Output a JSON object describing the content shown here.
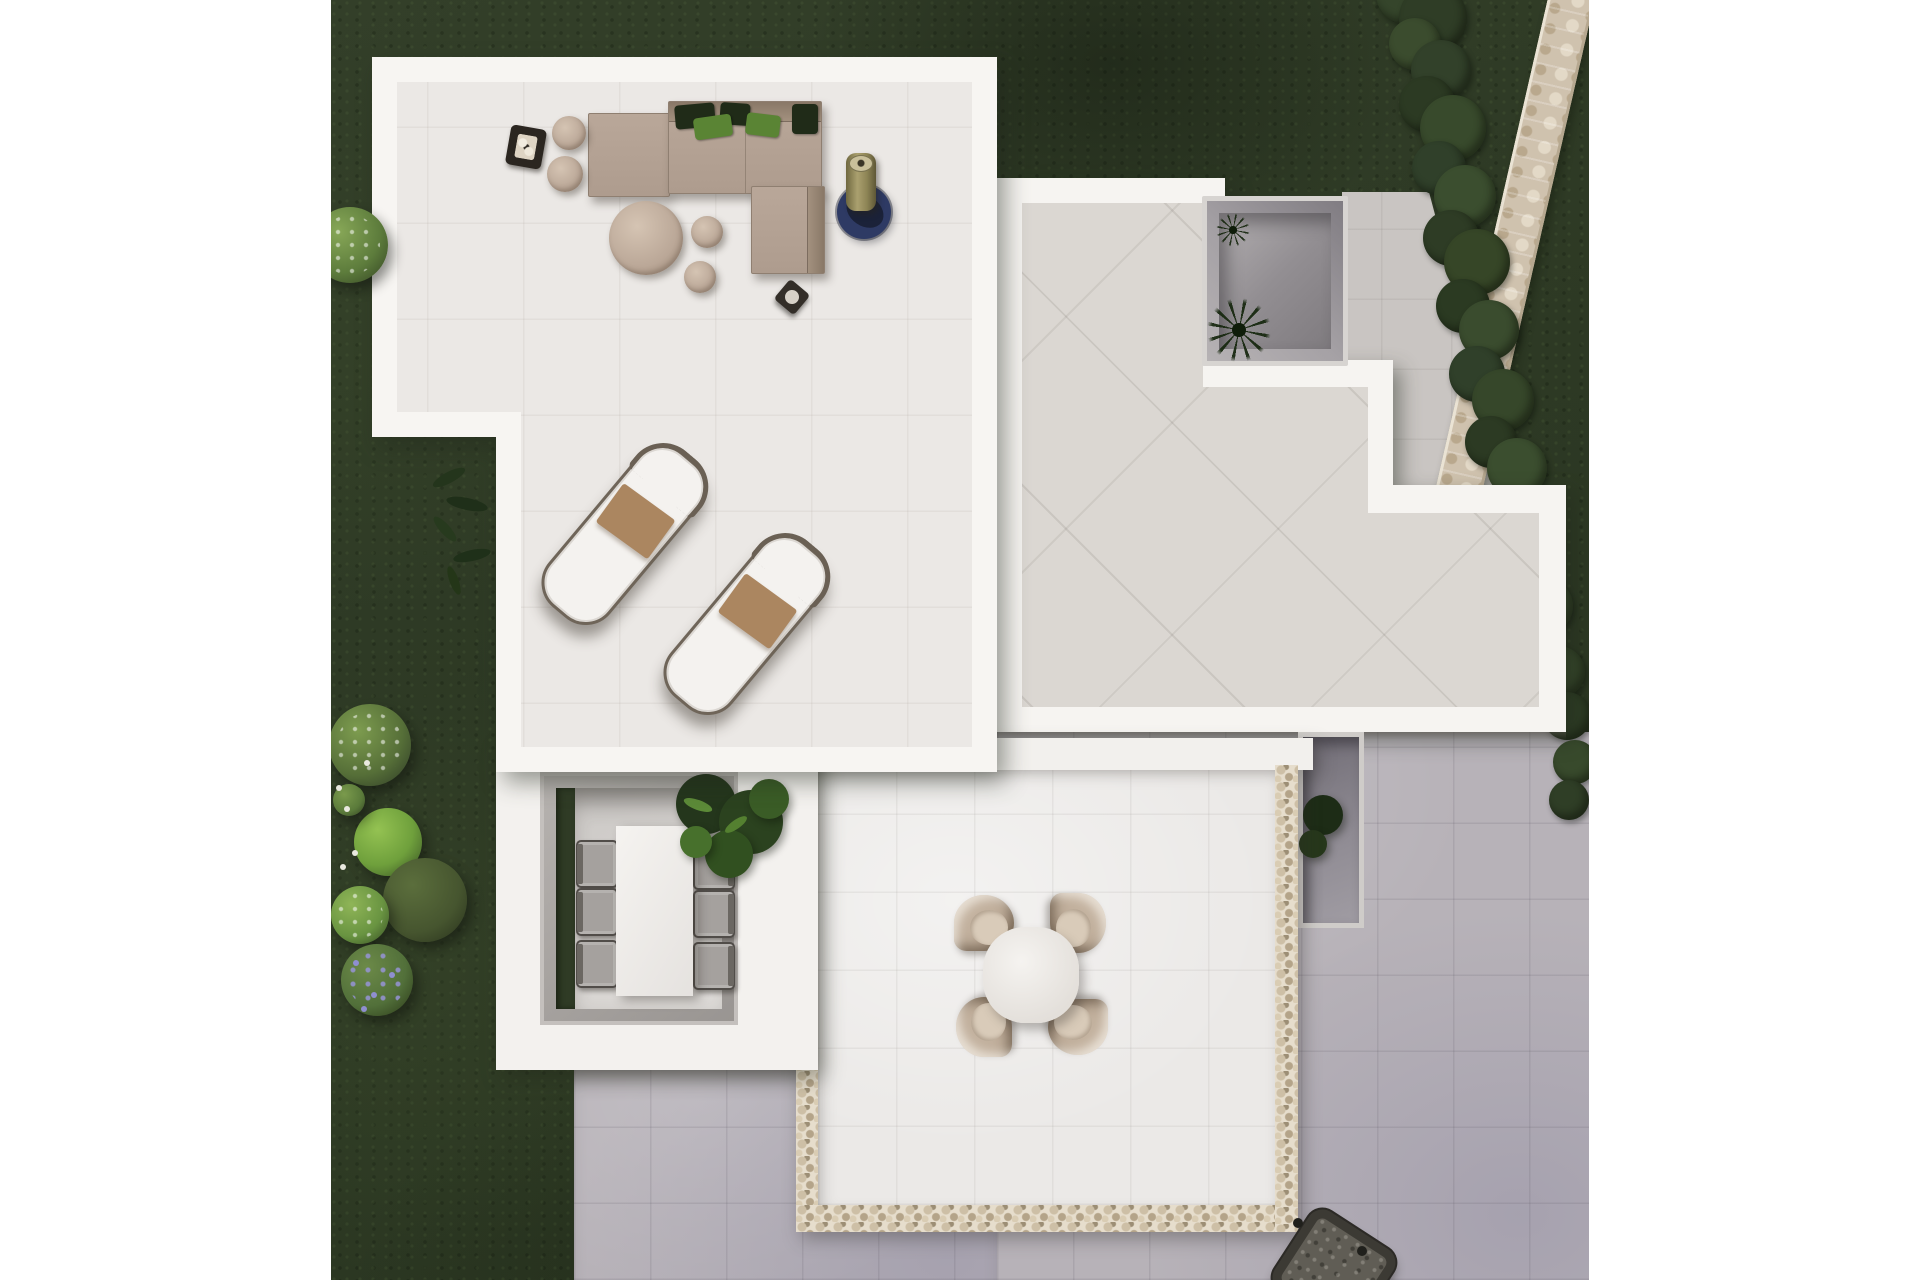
{
  "meta": {
    "title": "Aerial 3D render of a modern villa with roof terraces and garden",
    "canvas": {
      "width": 1920,
      "height": 1280
    },
    "content_area": {
      "left": 331,
      "width": 1258,
      "height": 1280
    }
  },
  "palette": {
    "page": "#ffffff",
    "grass": "#2e3a25",
    "hedge": "#35452b",
    "wallStone": "#cfc2ae",
    "structureWhite": "#f6f4f1",
    "loungeTile": "#ebe8e5",
    "buildingTile": "#dbd7d2",
    "pavingCool": "#b7b2b8",
    "pavingWarm": "#c9c5c2",
    "pebble": "#e6ddcc",
    "courtyardWall": "#a5a1a5",
    "sofaTaupe": "#b3a193",
    "pillowDark": "#202b18",
    "pillowGreen": "#5a8434",
    "woodTaupe": "#bba898",
    "towel": "#ab8660",
    "loungerCushion": "#f4f2ef",
    "loungerFrame": "#6f6559",
    "rugBlue": "#2e3a64",
    "heaterKhaki": "#a49a6b",
    "tableWhite": "#f2f0ed",
    "chairTaupe": "#c0ae9b",
    "chairGray": "#a5a19e",
    "plantDark": "#24361c",
    "plantMid": "#315020",
    "plantLight": "#47702c",
    "flowerPurple": "#8f8fd0",
    "flowerWhite": "#e9e9df",
    "firePit": "#605d55"
  },
  "objects": [
    {
      "name": "lawn",
      "label": "dark green garden lawn"
    },
    {
      "name": "perimeter-stone-wall",
      "label": "diagonal natural stone wall, top right"
    },
    {
      "name": "boxwood-hedge",
      "label": "irregular hedge along the stone wall"
    },
    {
      "name": "lounge-roof-terrace",
      "label": "white-parapet terrace, top left"
    },
    {
      "name": "corner-sofa",
      "label": "taupe L-shaped outdoor sofa with green pillows"
    },
    {
      "name": "coffee-table",
      "label": "round taupe coffee table with two poufs"
    },
    {
      "name": "side-tables",
      "label": "two cylindrical side tables"
    },
    {
      "name": "candle-lantern",
      "label": "dark square lantern tray"
    },
    {
      "name": "outdoor-rug",
      "label": "round navy rug with patio heater"
    },
    {
      "name": "side-stool",
      "label": "small dark stool"
    },
    {
      "name": "sun-loungers",
      "label": "two white sun loungers with brown towels",
      "count": 2
    },
    {
      "name": "central-roof-terrace",
      "label": "stepped white roof with diagonal stone tiles"
    },
    {
      "name": "sunken-courtyard",
      "label": "recessed courtyard with palm"
    },
    {
      "name": "paved-patio",
      "label": "gray tiled ground patios"
    },
    {
      "name": "sunken-dining-patio",
      "label": "recessed dining area with table and six chairs"
    },
    {
      "name": "potted-fig-plant",
      "label": "leafy green plant beside dining patio"
    },
    {
      "name": "pebble-bordered-terrace",
      "label": "lower terrace framed with pebble strip"
    },
    {
      "name": "round-bistro-set",
      "label": "round table with four taupe chairs"
    },
    {
      "name": "sunken-planter",
      "label": "small recessed planter with dark plant"
    },
    {
      "name": "garden-bushes",
      "label": "shrubs and flowering bushes, left edge"
    },
    {
      "name": "lavender-patch",
      "label": "purple flowering patch, lower left"
    },
    {
      "name": "fire-pit-grill",
      "label": "dark square fire pit, bottom right"
    }
  ],
  "shapes": [
    {
      "layer": "hedge",
      "name": "hedge-blob",
      "cls": "hblob",
      "x": 1045,
      "y": -36,
      "r": 30,
      "bg": "#35452b"
    },
    {
      "layer": "hedge",
      "name": "hedge-blob",
      "cls": "hblob",
      "x": 1068,
      "y": -16,
      "r": 34,
      "bg": "#2f3d26"
    },
    {
      "layer": "hedge",
      "name": "hedge-blob",
      "cls": "hblob",
      "x": 1058,
      "y": 18,
      "r": 26,
      "bg": "#3b4c2e"
    },
    {
      "layer": "hedge",
      "name": "hedge-blob",
      "cls": "hblob",
      "x": 1080,
      "y": 40,
      "r": 30,
      "bg": "#32412a"
    },
    {
      "layer": "hedge",
      "name": "hedge-blob",
      "cls": "hblob",
      "x": 1068,
      "y": 76,
      "r": 28,
      "bg": "#2c3a23"
    },
    {
      "layer": "hedge",
      "name": "hedge-blob",
      "cls": "hblob",
      "x": 1089,
      "y": 95,
      "r": 33,
      "bg": "#384a2c"
    },
    {
      "layer": "hedge",
      "name": "hedge-blob",
      "cls": "hblob",
      "x": 1081,
      "y": 141,
      "r": 27,
      "bg": "#30402a"
    },
    {
      "layer": "hedge",
      "name": "hedge-blob",
      "cls": "hblob",
      "x": 1103,
      "y": 165,
      "r": 31,
      "bg": "#3b4e2f"
    },
    {
      "layer": "hedge",
      "name": "hedge-blob",
      "cls": "hblob",
      "x": 1092,
      "y": 210,
      "r": 28,
      "bg": "#2e3c25"
    },
    {
      "layer": "hedge",
      "name": "hedge-blob",
      "cls": "hblob",
      "x": 1113,
      "y": 229,
      "r": 33,
      "bg": "#364627"
    },
    {
      "layer": "hedge",
      "name": "hedge-blob",
      "cls": "hblob",
      "x": 1105,
      "y": 279,
      "r": 27,
      "bg": "#2b3a22"
    },
    {
      "layer": "hedge",
      "name": "hedge-blob",
      "cls": "hblob",
      "x": 1128,
      "y": 300,
      "r": 30,
      "bg": "#3a4c2e"
    },
    {
      "layer": "hedge",
      "name": "hedge-blob",
      "cls": "hblob",
      "x": 1118,
      "y": 346,
      "r": 28,
      "bg": "#30402a"
    },
    {
      "layer": "hedge",
      "name": "hedge-blob",
      "cls": "hblob",
      "x": 1141,
      "y": 369,
      "r": 31,
      "bg": "#36472a"
    },
    {
      "layer": "hedge",
      "name": "hedge-blob",
      "cls": "hblob",
      "x": 1134,
      "y": 416,
      "r": 26,
      "bg": "#2c3a23"
    },
    {
      "layer": "hedge",
      "name": "hedge-blob",
      "cls": "hblob",
      "x": 1156,
      "y": 438,
      "r": 30,
      "bg": "#3b4e2f"
    },
    {
      "layer": "hedge",
      "name": "hedge-blob",
      "cls": "hblob",
      "x": 1149,
      "y": 485,
      "r": 27,
      "bg": "#31422a"
    },
    {
      "layer": "hedge",
      "name": "hedge-blob",
      "cls": "hblob",
      "x": 1170,
      "y": 508,
      "r": 30,
      "bg": "#364728"
    },
    {
      "layer": "hedge",
      "name": "hedge-blob",
      "cls": "hblob",
      "x": 1166,
      "y": 554,
      "r": 26,
      "bg": "#2d3b24"
    },
    {
      "layer": "hedge",
      "name": "hedge-blob",
      "cls": "hblob",
      "x": 1186,
      "y": 578,
      "r": 28,
      "bg": "#3a4c2e"
    },
    {
      "layer": "hedge",
      "name": "hedge-blob",
      "cls": "hblob",
      "x": 1182,
      "y": 624,
      "r": 24,
      "bg": "#30402a"
    },
    {
      "layer": "hedge",
      "name": "hedge-blob",
      "cls": "hblob",
      "x": 1202,
      "y": 646,
      "r": 26,
      "bg": "#35462a"
    },
    {
      "layer": "hedge",
      "name": "hedge-blob",
      "cls": "hblob",
      "x": 1212,
      "y": 692,
      "r": 24,
      "bg": "#2d3c24"
    },
    {
      "layer": "hedge",
      "name": "hedge-blob",
      "cls": "hblob",
      "x": 1222,
      "y": 740,
      "r": 22,
      "bg": "#384a2c"
    },
    {
      "layer": "hedge",
      "name": "hedge-blob",
      "cls": "hblob",
      "x": 1218,
      "y": 780,
      "r": 20,
      "bg": "#2f3e26"
    },
    {
      "layer": "veg",
      "name": "bush",
      "cls": "bush speck",
      "x": -19,
      "y": 207,
      "r": 38,
      "bg": "radial-gradient(circle at 35% 32%, #87a757, #5d7c3c 58%, #3c4f28 90%)"
    },
    {
      "layer": "veg",
      "name": "bush",
      "cls": "bush speck",
      "x": -2,
      "y": 704,
      "r": 41,
      "bg": "radial-gradient(circle at 35% 32%, #7d9c4f, #566f38 58%, #36452a 90%)"
    },
    {
      "layer": "veg",
      "name": "bush",
      "cls": "bush",
      "x": 23,
      "y": 808,
      "r": 34,
      "bg": "radial-gradient(circle at 35% 32%, #94c252, #6fa03c 55%, #44632a 90%)"
    },
    {
      "layer": "veg",
      "name": "bush",
      "cls": "bush",
      "x": 52,
      "y": 858,
      "r": 42,
      "bg": "radial-gradient(circle at 35% 32%, #5b6e3c, #46552f 60%, #2d371f 92%)"
    },
    {
      "layer": "veg",
      "name": "bush",
      "cls": "bush speck",
      "x": 0,
      "y": 886,
      "r": 29,
      "bg": "radial-gradient(circle at 35% 32%, #8fb557, #699441 58%, #415c2a 90%)"
    },
    {
      "layer": "veg",
      "name": "bush",
      "cls": "bush speckp",
      "x": 10,
      "y": 944,
      "r": 36,
      "bg": "radial-gradient(circle at 35% 32%, #6c8a48, #52703a 58%, #33441f 90%)"
    },
    {
      "layer": "veg",
      "name": "bush",
      "cls": "bush",
      "x": 2,
      "y": 784,
      "r": 16,
      "bg": "radial-gradient(circle at 35% 32%, #7a9a4c, #5a7a3a 60%, #3a4c26 92%)"
    },
    {
      "layer": "veg",
      "name": "flower-dot",
      "cls": "dot",
      "x": 5,
      "y": 785,
      "r": 3,
      "bg": "#e9e9df"
    },
    {
      "layer": "veg",
      "name": "flower-dot",
      "cls": "dot",
      "x": 13,
      "y": 806,
      "r": 3,
      "bg": "#e9e9df"
    },
    {
      "layer": "veg",
      "name": "flower-dot",
      "cls": "dot",
      "x": 21,
      "y": 850,
      "r": 3,
      "bg": "#e9e9df"
    },
    {
      "layer": "veg",
      "name": "flower-dot",
      "cls": "dot",
      "x": 9,
      "y": 864,
      "r": 3,
      "bg": "#e9e9df"
    },
    {
      "layer": "veg",
      "name": "flower-dot",
      "cls": "dot",
      "x": 33,
      "y": 760,
      "r": 3,
      "bg": "#e9e9df"
    },
    {
      "layer": "veg",
      "name": "flower-dot",
      "cls": "dot",
      "x": 22,
      "y": 960,
      "r": 3,
      "bg": "#8f8fd0"
    },
    {
      "layer": "veg",
      "name": "flower-dot",
      "cls": "dot",
      "x": 40,
      "y": 992,
      "r": 3,
      "bg": "#8f8fd0"
    },
    {
      "layer": "veg",
      "name": "flower-dot",
      "cls": "dot",
      "x": 58,
      "y": 972,
      "r": 3,
      "bg": "#8f8fd0"
    },
    {
      "layer": "veg",
      "name": "flower-dot",
      "cls": "dot",
      "x": 30,
      "y": 1006,
      "r": 3,
      "bg": "#8f8fd0"
    },
    {
      "layer": "veg",
      "name": "climbing-plant-leaf",
      "cls": "leaf",
      "x": 100,
      "y": 472,
      "w": 36,
      "h": 11,
      "rot": -28,
      "bg": "#24351c"
    },
    {
      "layer": "veg",
      "name": "climbing-plant-leaf",
      "cls": "leaf",
      "x": 115,
      "y": 498,
      "w": 42,
      "h": 12,
      "rot": 12,
      "bg": "#1f2f19"
    },
    {
      "layer": "veg",
      "name": "climbing-plant-leaf",
      "cls": "leaf",
      "x": 98,
      "y": 524,
      "w": 32,
      "h": 10,
      "rot": 48,
      "bg": "#273a1e"
    },
    {
      "layer": "veg",
      "name": "climbing-plant-leaf",
      "cls": "leaf",
      "x": 122,
      "y": 550,
      "w": 38,
      "h": 11,
      "rot": -12,
      "bg": "#1f3019"
    },
    {
      "layer": "veg",
      "name": "climbing-plant-leaf",
      "cls": "leaf",
      "x": 108,
      "y": 576,
      "w": 30,
      "h": 9,
      "rot": 70,
      "bg": "#243618"
    },
    {
      "layer": "loungef",
      "name": "sofa-chaise",
      "cls": "sofa",
      "x": 257,
      "y": 113,
      "w": 80,
      "h": 82
    },
    {
      "layer": "loungef",
      "name": "sofa-main",
      "cls": "sofa sofa-top",
      "x": 337,
      "y": 101,
      "w": 152,
      "h": 91
    },
    {
      "layer": "loungef",
      "name": "sofa-corner-module",
      "cls": "sofa sofa-rightband",
      "x": 420,
      "y": 186,
      "w": 72,
      "h": 86
    },
    {
      "layer": "loungef",
      "name": "sofa-pillow",
      "cls": "pillow",
      "x": 344,
      "y": 104,
      "w": 40,
      "h": 24,
      "rot": -5,
      "bg": "@pillowDark"
    },
    {
      "layer": "loungef",
      "name": "sofa-pillow",
      "cls": "pillow",
      "x": 389,
      "y": 103,
      "w": 30,
      "h": 22,
      "rot": 4,
      "bg": "@pillowDark"
    },
    {
      "layer": "loungef",
      "name": "sofa-pillow",
      "cls": "pillow",
      "x": 363,
      "y": 116,
      "w": 38,
      "h": 22,
      "rot": -8,
      "bg": "@pillowGreen"
    },
    {
      "layer": "loungef",
      "name": "sofa-pillow",
      "cls": "pillow",
      "x": 415,
      "y": 114,
      "w": 34,
      "h": 22,
      "rot": 7,
      "bg": "@pillowGreen"
    },
    {
      "layer": "loungef",
      "name": "sofa-pillow",
      "cls": "pillow",
      "x": 461,
      "y": 104,
      "w": 26,
      "h": 30,
      "rot": 0,
      "bg": "@pillowDark"
    },
    {
      "layer": "loungef",
      "name": "side-table",
      "cls": "woodtop",
      "x": 221,
      "y": 116,
      "r": 17
    },
    {
      "layer": "loungef",
      "name": "side-table",
      "cls": "woodtop",
      "x": 216,
      "y": 156,
      "r": 18
    },
    {
      "layer": "loungef",
      "name": "candle-lantern",
      "cls": "lantern",
      "x": 177,
      "y": 127,
      "w": 36,
      "h": 40,
      "rot": 10
    },
    {
      "layer": "loungef",
      "name": "coffee-table",
      "cls": "woodtop",
      "x": 278,
      "y": 201,
      "r": 37
    },
    {
      "layer": "loungef",
      "name": "pouf",
      "cls": "woodtop",
      "x": 360,
      "y": 216,
      "r": 16
    },
    {
      "layer": "loungef",
      "name": "pouf",
      "cls": "woodtop",
      "x": 353,
      "y": 261,
      "r": 16
    },
    {
      "layer": "loungef",
      "name": "outdoor-rug",
      "cls": "rug",
      "x": 506,
      "y": 185,
      "r": 27,
      "bg": "@rugBlue"
    },
    {
      "layer": "loungef",
      "name": "rug-shadow",
      "cls": "leaf",
      "x": 514,
      "y": 196,
      "w": 40,
      "h": 30,
      "rot": 35,
      "bg": "rgba(8,10,14,.5)"
    },
    {
      "layer": "loungef",
      "name": "patio-heater",
      "cls": "heater",
      "x": 515,
      "y": 153,
      "w": 30,
      "h": 58
    },
    {
      "layer": "loungef",
      "name": "side-stool",
      "cls": "stool",
      "x": 448,
      "y": 284,
      "w": 26,
      "h": 26,
      "rot": 40
    },
    {
      "layer": "loungef",
      "name": "sun-lounger",
      "cls": "lounger",
      "x": 253,
      "y": 434,
      "w": 74,
      "h": 196,
      "rot": 40
    },
    {
      "layer": "loungef",
      "name": "sun-lounger",
      "cls": "lounger",
      "x": 375,
      "y": 524,
      "w": 74,
      "h": 196,
      "rot": 40
    },
    {
      "layer": "rtchairs",
      "name": "bistro-chair",
      "cls": "rt-chair",
      "x": 623,
      "y": 895,
      "rot": 0
    },
    {
      "layer": "rtchairs",
      "name": "bistro-chair",
      "cls": "rt-chair",
      "x": 717,
      "y": 895,
      "rot": 90
    },
    {
      "layer": "rtchairs",
      "name": "bistro-chair",
      "cls": "rt-chair",
      "x": 717,
      "y": 999,
      "rot": 180
    },
    {
      "layer": "rtchairs",
      "name": "bistro-chair",
      "cls": "rt-chair",
      "x": 623,
      "y": 999,
      "rot": 270
    },
    {
      "layer": "dinchairs",
      "name": "dining-chair",
      "cls": "din-chair din-left",
      "x": 245,
      "y": 840,
      "w": 38,
      "h": 44
    },
    {
      "layer": "dinchairs",
      "name": "dining-chair",
      "cls": "din-chair din-left",
      "x": 245,
      "y": 888,
      "w": 38,
      "h": 44
    },
    {
      "layer": "dinchairs",
      "name": "dining-chair",
      "cls": "din-chair din-left",
      "x": 245,
      "y": 940,
      "w": 38,
      "h": 44
    },
    {
      "layer": "dinchairs",
      "name": "dining-chair",
      "cls": "din-chair din-right",
      "x": 362,
      "y": 842,
      "w": 38,
      "h": 44
    },
    {
      "layer": "dinchairs",
      "name": "dining-chair",
      "cls": "din-chair din-right",
      "x": 362,
      "y": 890,
      "w": 38,
      "h": 44
    },
    {
      "layer": "dinchairs",
      "name": "dining-chair",
      "cls": "din-chair din-right",
      "x": 362,
      "y": 942,
      "w": 38,
      "h": 44
    },
    {
      "layer": "dinplant",
      "name": "fig-plant-foliage",
      "cls": "fol",
      "x": 345,
      "y": 774,
      "r": 30,
      "bg": "@plantDark"
    },
    {
      "layer": "dinplant",
      "name": "fig-plant-foliage",
      "cls": "fol",
      "x": 388,
      "y": 790,
      "r": 32,
      "bg": "#2b421f"
    },
    {
      "layer": "dinplant",
      "name": "fig-plant-foliage",
      "cls": "fol",
      "x": 374,
      "y": 830,
      "r": 24,
      "bg": "@plantMid"
    },
    {
      "layer": "dinplant",
      "name": "fig-plant-foliage",
      "cls": "fol",
      "x": 418,
      "y": 779,
      "r": 20,
      "bg": "#3a5c26"
    },
    {
      "layer": "dinplant",
      "name": "fig-plant-foliage",
      "cls": "fol",
      "x": 349,
      "y": 826,
      "r": 16,
      "bg": "@plantLight"
    },
    {
      "layer": "dinplant",
      "name": "fig-plant-leaf",
      "cls": "leaf",
      "x": 352,
      "y": 800,
      "w": 30,
      "h": 10,
      "rot": 20,
      "bg": "#5c8a38"
    },
    {
      "layer": "dinplant",
      "name": "fig-plant-leaf",
      "cls": "leaf",
      "x": 392,
      "y": 820,
      "w": 26,
      "h": 9,
      "rot": -35,
      "bg": "#548030"
    },
    {
      "layer": "planterlayer",
      "name": "planter-plant",
      "cls": "fol",
      "x": 972,
      "y": 795,
      "r": 20,
      "bg": "#1d2c16"
    },
    {
      "layer": "planterlayer",
      "name": "planter-plant",
      "cls": "fol",
      "x": 968,
      "y": 830,
      "r": 14,
      "bg": "#26371b"
    },
    {
      "layer": "fp",
      "name": "fire-pit-foot",
      "cls": "foot",
      "x": 962,
      "y": 1218,
      "r": 5
    },
    {
      "layer": "fp",
      "name": "fire-pit-foot",
      "cls": "foot",
      "x": 1026,
      "y": 1246,
      "r": 5
    }
  ]
}
